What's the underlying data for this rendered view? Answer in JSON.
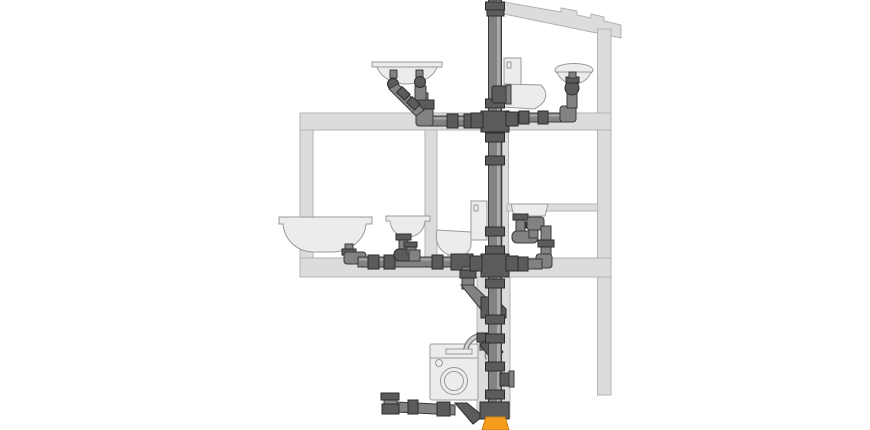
{
  "diagram": {
    "name": "building-drainage-piping-cutaway",
    "levels": [
      {
        "name": "attic-bathroom",
        "components": [
          "vent-stack-top",
          "double-trap-washbasin",
          "wall-hung-toilet",
          "small-washbasin",
          "left-branch-drain",
          "right-branch-drain"
        ]
      },
      {
        "name": "first-floor-bathroom-and-kitchen",
        "components": [
          "bathtub",
          "washbasin-with-trap",
          "toilet-with-cistern",
          "kitchen-sink-with-loop-trap",
          "floor-branch-drain",
          "stack-offset-wye"
        ]
      },
      {
        "name": "ground-floor",
        "components": [
          "washing-machine",
          "washing-machine-drain-hose",
          "standpipe-branch",
          "access-fitting",
          "basement-branch-drain",
          "underground-transition-adapter"
        ]
      }
    ]
  },
  "colors": {
    "background": "#ffffff",
    "wall_fill": "#dcdcdc",
    "wall_stroke": "#b3b3b3",
    "fixture_fill": "#ececec",
    "fixture_stroke": "#9a9a9a",
    "pipe_fill": "#828282",
    "pipe_highlight": "#a9a9a9",
    "pipe_stroke": "#3a3a3a",
    "fitting_fill": "#5b5b5b",
    "fitting_stroke": "#2c2c2c",
    "hose_outer": "#7d7d7d",
    "hose_inner": "#cfcfcf",
    "adapter_fill": "#f69d1d",
    "adapter_stroke": "#c97e0f"
  }
}
